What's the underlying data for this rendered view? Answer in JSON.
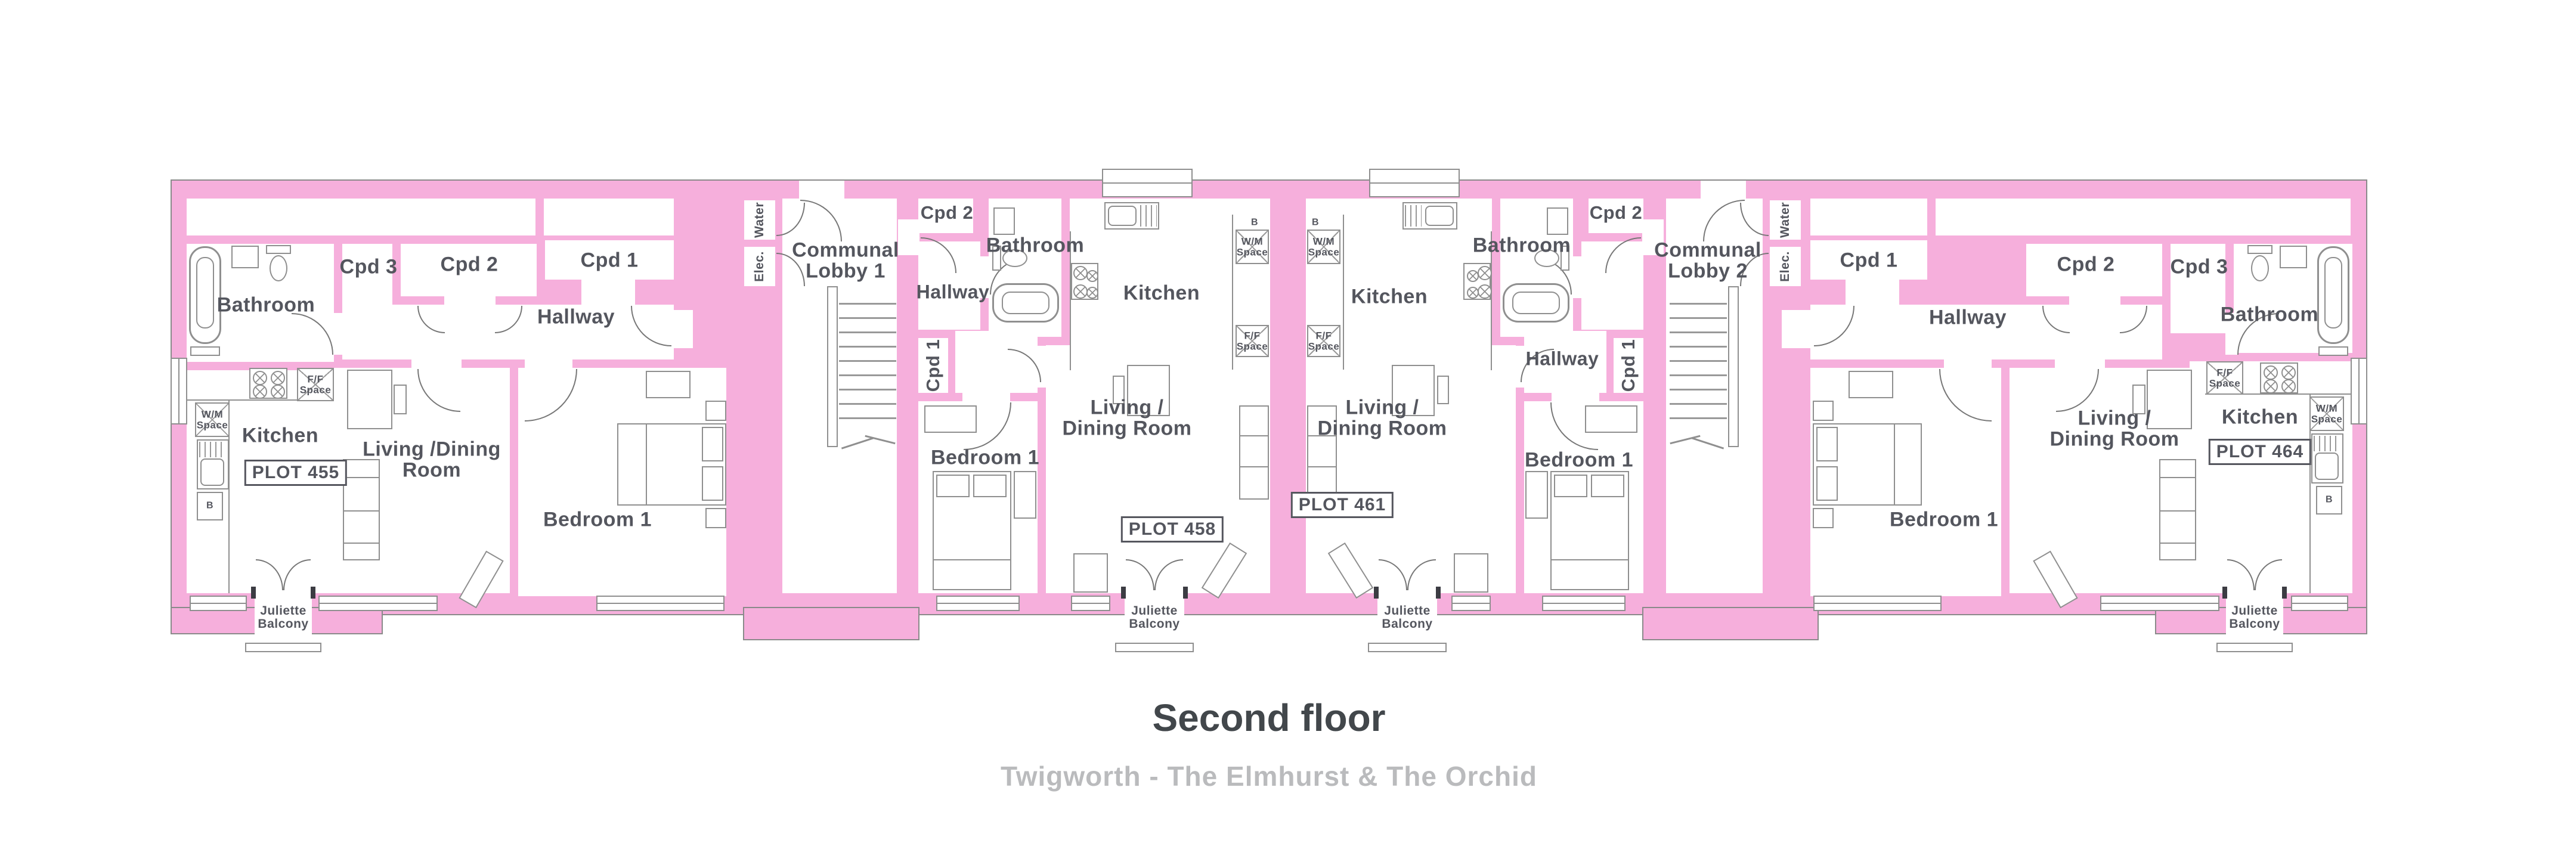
{
  "footer": {
    "title": "Second floor",
    "subtitle": "Twigworth - The Elmhurst & The Orchid"
  },
  "rooms": {
    "bathroom": "Bathroom",
    "hallway": "Hallway",
    "kitchen": "Kitchen",
    "bedroom1": "Bedroom 1",
    "cpd1": "Cpd 1",
    "cpd2": "Cpd 2",
    "cpd3": "Cpd 3",
    "living_a": "Living /Dining\nRoom",
    "living_b": "Living /\nDining Room"
  },
  "lobbies": {
    "lobby1": "Communal\nLobby 1",
    "lobby2": "Communal\nLobby 2"
  },
  "utilities": {
    "water": "Water",
    "elec": "Elec.",
    "wm": "W/M\nSpace",
    "ff": "F/F\nSpace",
    "boiler": "B",
    "juliette": "Juliette\nBalcony"
  },
  "plots": {
    "p455": {
      "badge": "PLOT 455"
    },
    "p458": {
      "badge": "PLOT 458"
    },
    "p461": {
      "badge": "PLOT 461"
    },
    "p464": {
      "badge": "PLOT 464"
    }
  }
}
